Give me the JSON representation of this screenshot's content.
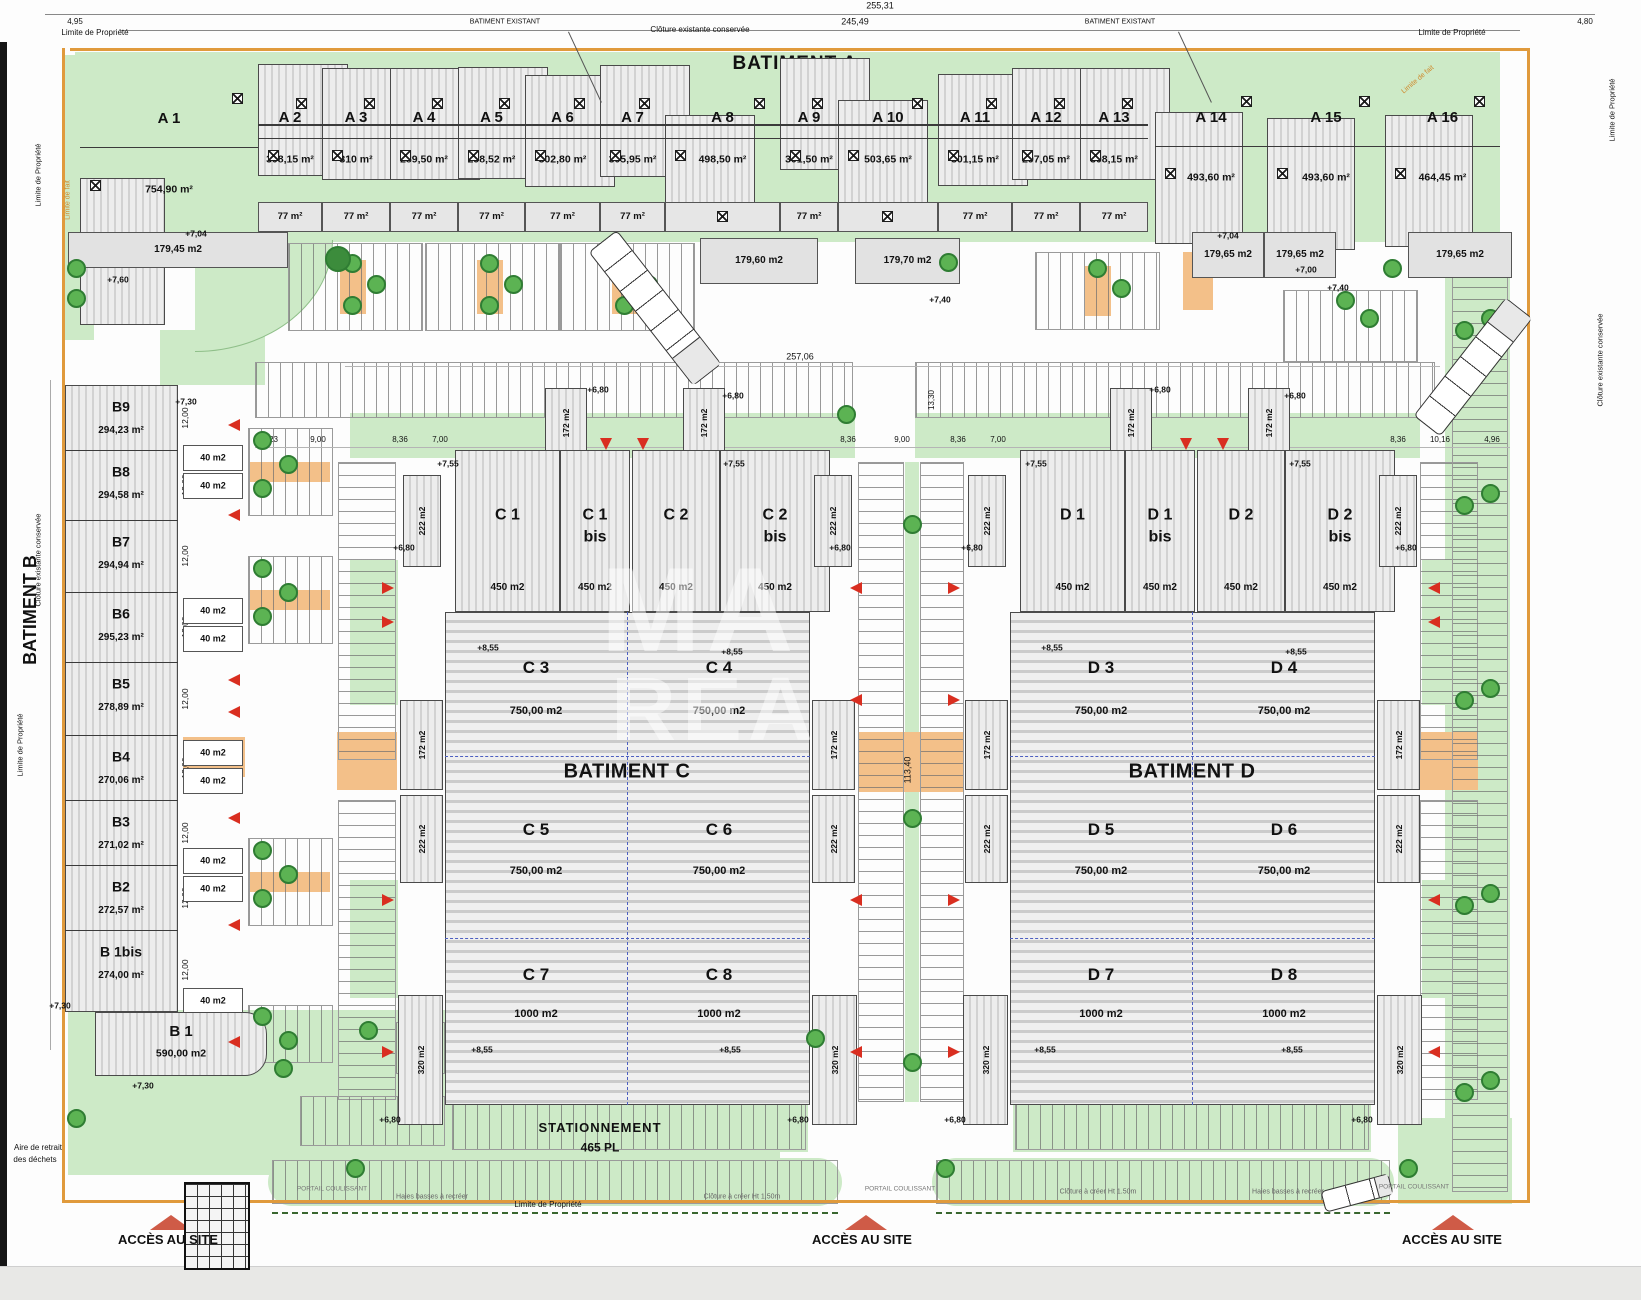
{
  "titles": {
    "a": "BATIMENT A",
    "b": "BATIMENT B",
    "c": "BATIMENT C",
    "d": "BATIMENT D"
  },
  "edge": {
    "limite_propriete": "Limite de Propriété",
    "cloture_existante": "Clôture existante conservée",
    "limite_de_fait": "Limite de fait",
    "batiment_existant": "BATIMENT EXISTANT",
    "aire1": "Aire de retrait",
    "aire2": "des déchets"
  },
  "bottom": {
    "stationnement": "STATIONNEMENT",
    "places": "465 PL",
    "acces": "ACCÈS AU SITE",
    "portail": "PORTAIL COULISSANT",
    "cloture_creer": "Clôture à créer Ht 1.50m",
    "haies": "Haies basses à recréer"
  },
  "dims": {
    "total_width": "255,31",
    "inner_width": "245,49",
    "left_offset": "4,95",
    "right_offset": "4,80",
    "zone_width": "257,06",
    "zone_height": "113,40",
    "gap_top": "13,30",
    "b_module": "12,00",
    "b9_depth": "27,87",
    "row": [
      "13,23",
      "9,00",
      "8,36",
      "7,00",
      "8,36",
      "9,00",
      "8,36",
      "7,00",
      "8,36",
      "10,16",
      "4,96"
    ]
  },
  "levels": {
    "v680": "+6,80",
    "v700": "+7,00",
    "v704": "+7,04",
    "v730": "+7,30",
    "v740": "+7,40",
    "v755": "+7,55",
    "v760": "+7,60",
    "v855": "+8,55"
  },
  "areas": {
    "s40": "40 m2",
    "s77": "77 m²",
    "s172": "172 m2",
    "s222": "222 m2",
    "s320": "320 m2"
  },
  "a_units": [
    {
      "label": "A 1",
      "area": "754,90 m²"
    },
    {
      "label": "A 2",
      "area": "308,15 m²"
    },
    {
      "label": "A 3",
      "area": "310 m²"
    },
    {
      "label": "A 4",
      "area": "289,50 m²"
    },
    {
      "label": "A 5",
      "area": "298,52 m²"
    },
    {
      "label": "A 6",
      "area": "302,80 m²"
    },
    {
      "label": "A 7",
      "area": "305,95 m²"
    },
    {
      "label": "A 8",
      "area": "498,50 m²"
    },
    {
      "label": "A 9",
      "area": "301,50 m²"
    },
    {
      "label": "A 10",
      "area": "503,65 m²"
    },
    {
      "label": "A 11",
      "area": "301,15 m²"
    },
    {
      "label": "A 12",
      "area": "297,05 m²"
    },
    {
      "label": "A 13",
      "area": "308,15 m²"
    },
    {
      "label": "A 14",
      "area": "493,60 m²"
    },
    {
      "label": "A 15",
      "area": "493,60 m²"
    },
    {
      "label": "A 16",
      "area": "464,45 m²"
    }
  ],
  "a_annexes": [
    "179,45 m2",
    "179,60 m2",
    "179,70 m2",
    "179,65 m2",
    "179,65 m2",
    "179,65 m2"
  ],
  "b_units": [
    {
      "label": "B9",
      "area": "294,23 m²"
    },
    {
      "label": "B8",
      "area": "294,58 m²"
    },
    {
      "label": "B7",
      "area": "294,94 m²"
    },
    {
      "label": "B6",
      "area": "295,23 m²"
    },
    {
      "label": "B5",
      "area": "278,89 m²"
    },
    {
      "label": "B4",
      "area": "270,06 m²"
    },
    {
      "label": "B3",
      "area": "271,02 m²"
    },
    {
      "label": "B2",
      "area": "272,57 m²"
    },
    {
      "label": "B 1bis",
      "area": "274,00 m²"
    }
  ],
  "b1": {
    "label": "B 1",
    "area": "590,00 m2"
  },
  "c_top": [
    {
      "l1": "C 1",
      "l2": "",
      "area": "450 m2"
    },
    {
      "l1": "C 1",
      "l2": "bis",
      "area": "450 m2"
    },
    {
      "l1": "C 2",
      "l2": "",
      "area": "450 m2"
    },
    {
      "l1": "C 2",
      "l2": "bis",
      "area": "450 m2"
    }
  ],
  "c_main": [
    {
      "label": "C 3",
      "area": "750,00 m2"
    },
    {
      "label": "C 4",
      "area": "750,00 m2"
    },
    {
      "label": "C 5",
      "area": "750,00 m2"
    },
    {
      "label": "C 6",
      "area": "750,00 m2"
    },
    {
      "label": "C 7",
      "area": "1000 m2"
    },
    {
      "label": "C 8",
      "area": "1000 m2"
    }
  ],
  "d_top": [
    {
      "l1": "D 1",
      "l2": "",
      "area": "450 m2"
    },
    {
      "l1": "D 1",
      "l2": "bis",
      "area": "450 m2"
    },
    {
      "l1": "D 2",
      "l2": "",
      "area": "450 m2"
    },
    {
      "l1": "D 2",
      "l2": "bis",
      "area": "450 m2"
    }
  ],
  "d_main": [
    {
      "label": "D 3",
      "area": "750,00 m2"
    },
    {
      "label": "D 4",
      "area": "750,00 m2"
    },
    {
      "label": "D 5",
      "area": "750,00 m2"
    },
    {
      "label": "D 6",
      "area": "750,00 m2"
    },
    {
      "label": "D 7",
      "area": "1000 m2"
    },
    {
      "label": "D 8",
      "area": "1000 m2"
    }
  ],
  "watermark": {
    "l1": "MA",
    "l2": "REA"
  }
}
